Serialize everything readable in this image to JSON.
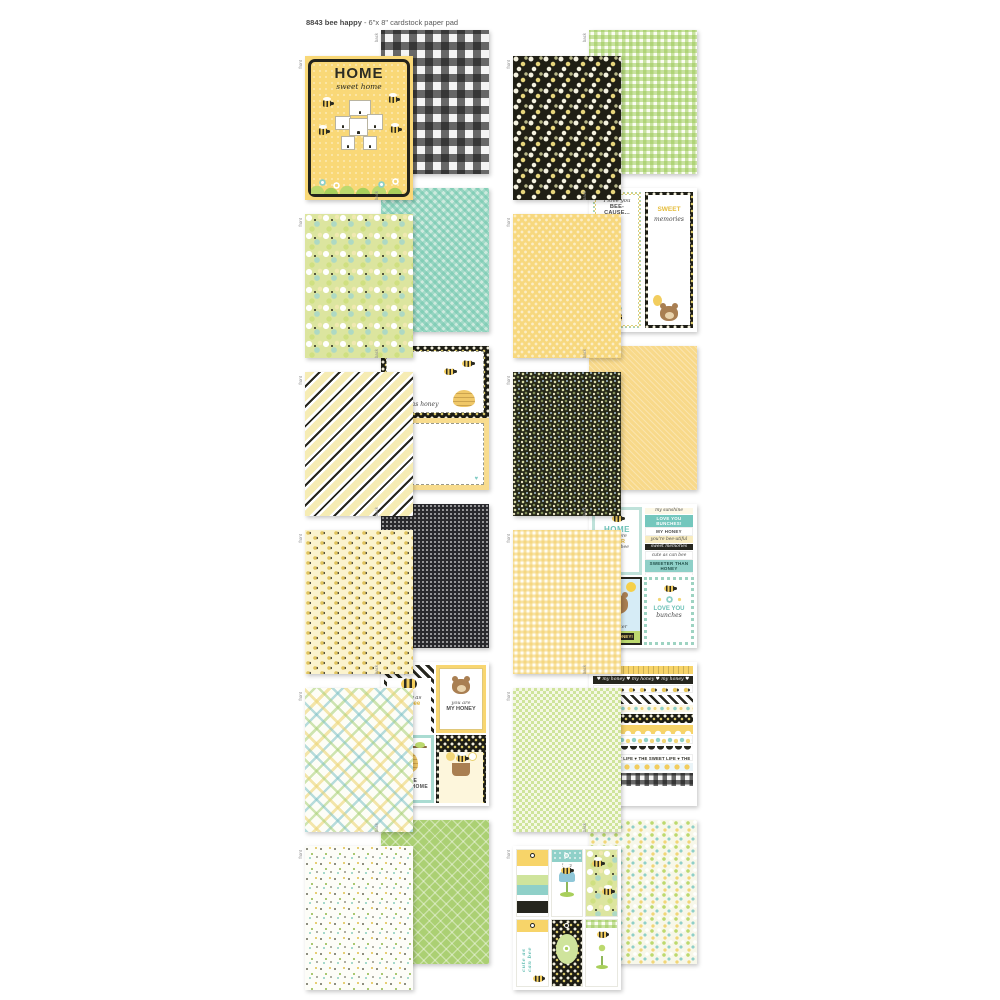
{
  "header": {
    "title_bold": "8843 bee happy",
    "title_rest": " - 6\"x 8\" cardstock paper pad"
  },
  "labels": {
    "front": "front",
    "back": "back"
  },
  "palette": {
    "yellow": "#f7d469",
    "green": "#bcd96e",
    "teal": "#8fd0c8",
    "black": "#26261e",
    "cream": "#fbf3cd",
    "aqua": "#9fd6c6"
  },
  "pairs": {
    "p1": {
      "front_pattern": "home-sweet-home-card",
      "back_pattern": "black-white-buffalo-check",
      "title": "HOME",
      "subtitle": "sweet home"
    },
    "p2": {
      "front_pattern": "white-daisies-on-black",
      "back_pattern": "green-gingham"
    },
    "p3": {
      "front_pattern": "bee-blossoms-green",
      "back_pattern": "aqua-diagonal-check"
    },
    "p4": {
      "front_pattern": "yellow-honeycomb-dot",
      "back_pattern": "journaling-list-cards",
      "card1_line1": "I love you",
      "card1_line2": "BEE-CAUSE...",
      "card2_word1": "SWEET",
      "card2_word2": "memories"
    },
    "p5": {
      "front_pattern": "black-yellow-diagonal-stripe",
      "back_pattern": "honey-journal-cards",
      "card1_caption": "sweet as honey"
    },
    "p6": {
      "front_pattern": "micro-floral-on-black",
      "back_pattern": "soft-yellow-texture"
    },
    "p7": {
      "front_pattern": "tiny-bees-on-cream",
      "back_pattern": "black-swiss-dot"
    },
    "p8": {
      "front_pattern": "yellow-gingham",
      "back_pattern": "card-panels-and-word-strips",
      "panel1_line1": "HOME",
      "panel1_line2": "is where",
      "panel1_line3": "YOUR",
      "panel1_line4": "honey bee",
      "strips": [
        "my sunshine",
        "LOVE YOU BUNCHES!",
        "MY HONEY",
        "you're bee-utiful",
        "sweet memories",
        "cute as can bee",
        "SWEETER THAN HONEY",
        "THE SWEET LIFE",
        "un-bee-lievable"
      ],
      "panel3_line1": "sweeter",
      "panel3_line2": "THAN HONEY!",
      "panel4_line1": "LOVE YOU",
      "panel4_line2": "bunches"
    },
    "p9": {
      "front_pattern": "diagonal-plaid",
      "back_pattern": "greeting-card-panels",
      "card1_line1": "happy as",
      "card1_line2": "can bee",
      "card2_line1": "you are",
      "card2_line2": "MY HONEY",
      "card3_line1": "HOME",
      "card3_line2": "SWEET HOME"
    },
    "p10": {
      "front_pattern": "green-check-dot",
      "back_pattern": "washi-border-strips",
      "strip_my_honey": "♥ my honey ♥ my honey ♥ my honey ♥",
      "strip_sweet_life": "THE SWEET LIFE  ♥  THE SWEET LIFE  ♥  THE SWEET LIFE"
    },
    "p11": {
      "front_pattern": "confetti-dots-on-white",
      "back_pattern": "green-lattice"
    },
    "p12": {
      "front_pattern": "tags-and-labels",
      "back_pattern": "ditsy-floral-cream",
      "tag2_text": "bzzz",
      "tag4_text": "cute as can bee"
    }
  }
}
